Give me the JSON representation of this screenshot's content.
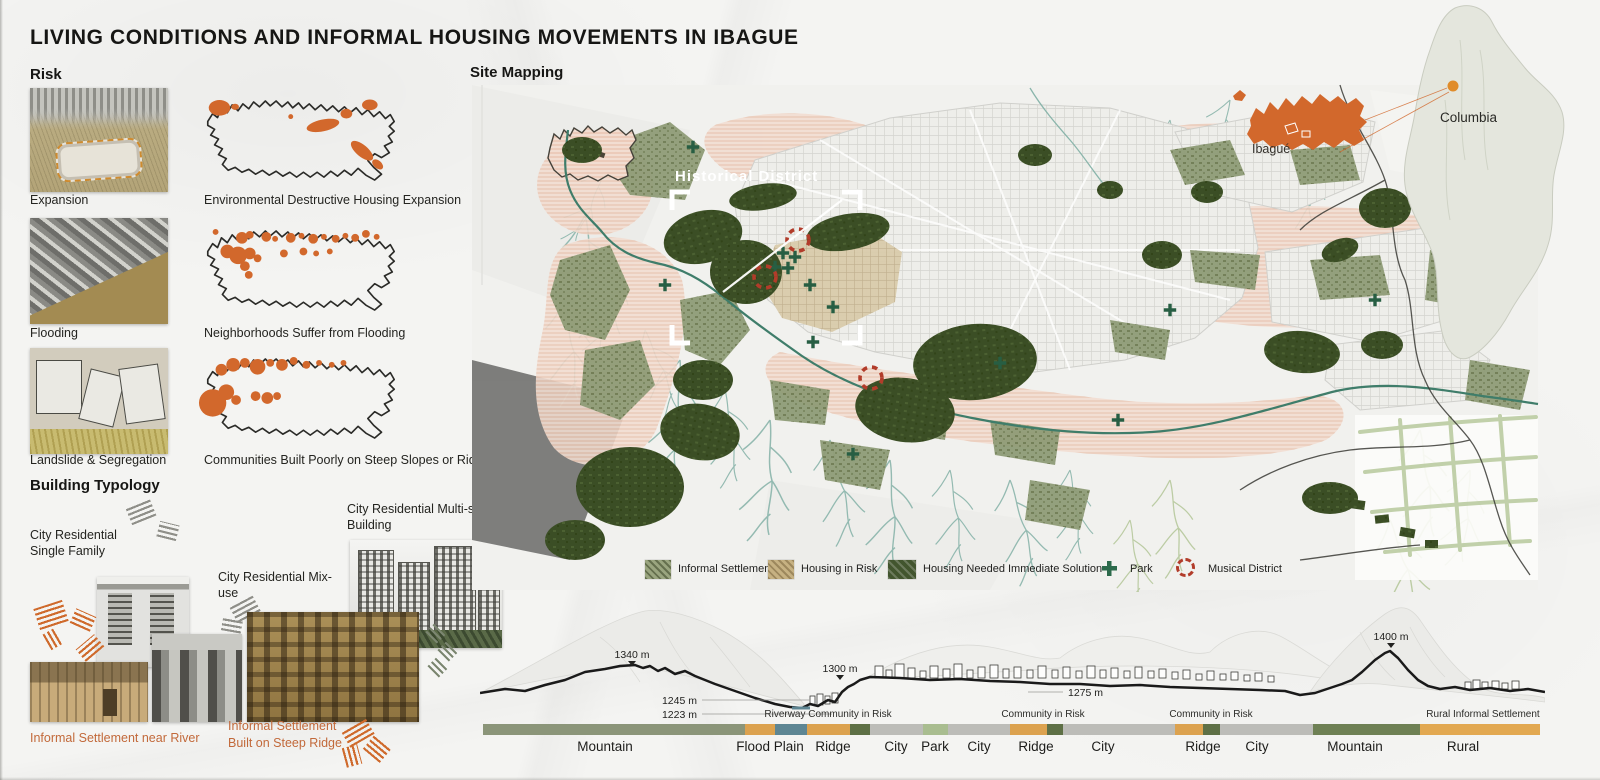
{
  "title": "LIVING CONDITIONS AND INFORMAL HOUSING MOVEMENTS IN IBAGUE",
  "risk": {
    "heading": "Risk",
    "rows": [
      {
        "photo_label": "Expansion",
        "map_caption": "Environmental Destructive Housing Expansion"
      },
      {
        "photo_label": "Flooding",
        "map_caption": "Neighborhoods Suffer from Flooding"
      },
      {
        "photo_label": "Landslide & Segregation",
        "map_caption": "Communities Built Poorly on Steep Slopes or Ridges"
      }
    ]
  },
  "typology": {
    "heading": "Building Typology",
    "single_family": "City Residential Single Family",
    "mix_use": "City Residential Mix-use",
    "multi_story": "City Residential Multi-story Building",
    "near_river": "Informal Settlement near River",
    "steep_ridge_line1": "Informal Settlement",
    "steep_ridge_line2": "Built on  Steep Ridge"
  },
  "site": {
    "heading": "Site Mapping",
    "historical_district": "Historical District",
    "ibague": "Ibagué",
    "columbia": "Columbia",
    "legend": [
      {
        "label": "Informal Settlement"
      },
      {
        "label": "Housing in Risk"
      },
      {
        "label": "Housing Needed Immediate Solution"
      },
      {
        "label": "Park"
      },
      {
        "label": "Musical District"
      }
    ]
  },
  "elevation": {
    "markers": [
      {
        "label": "1340 m"
      },
      {
        "label": "1245 m"
      },
      {
        "label": "1223 m"
      },
      {
        "label": "1300 m"
      },
      {
        "label": "1275 m"
      },
      {
        "label": "1400 m"
      }
    ],
    "annotations": [
      {
        "label": "Riverway  Community in Risk"
      },
      {
        "label": "Community in Risk"
      },
      {
        "label": "Community in Risk"
      },
      {
        "label": "Rural Informal Settlement"
      }
    ],
    "terrain": [
      {
        "label": "Mountain"
      },
      {
        "label": "Flood Plain"
      },
      {
        "label": "Ridge"
      },
      {
        "label": "City"
      },
      {
        "label": "Park"
      },
      {
        "label": "City"
      },
      {
        "label": "Ridge"
      },
      {
        "label": "City"
      },
      {
        "label": "Ridge"
      },
      {
        "label": "City"
      },
      {
        "label": "Mountain"
      },
      {
        "label": "Rural"
      }
    ],
    "palette": {
      "mountain_sage": "#8b9579",
      "flood_amber": "#dca24f",
      "river_teal": "#5e8693",
      "ridge_olive": "#5e7046",
      "city_gray": "#bcbcb8",
      "park_green": "#a9bd90",
      "mountain_green": "#6e8054",
      "rural_amber": "#e2a851"
    }
  },
  "colors": {
    "accent_orange": "#d2682c",
    "dark_green": "#3b4e25",
    "map_olive": "#8f9c77",
    "risk_salmon": "#f2ddd1",
    "stream_teal": "#8ab5ab",
    "musical_red": "#b23c2a",
    "park_cross_green": "#2c6a4b"
  }
}
